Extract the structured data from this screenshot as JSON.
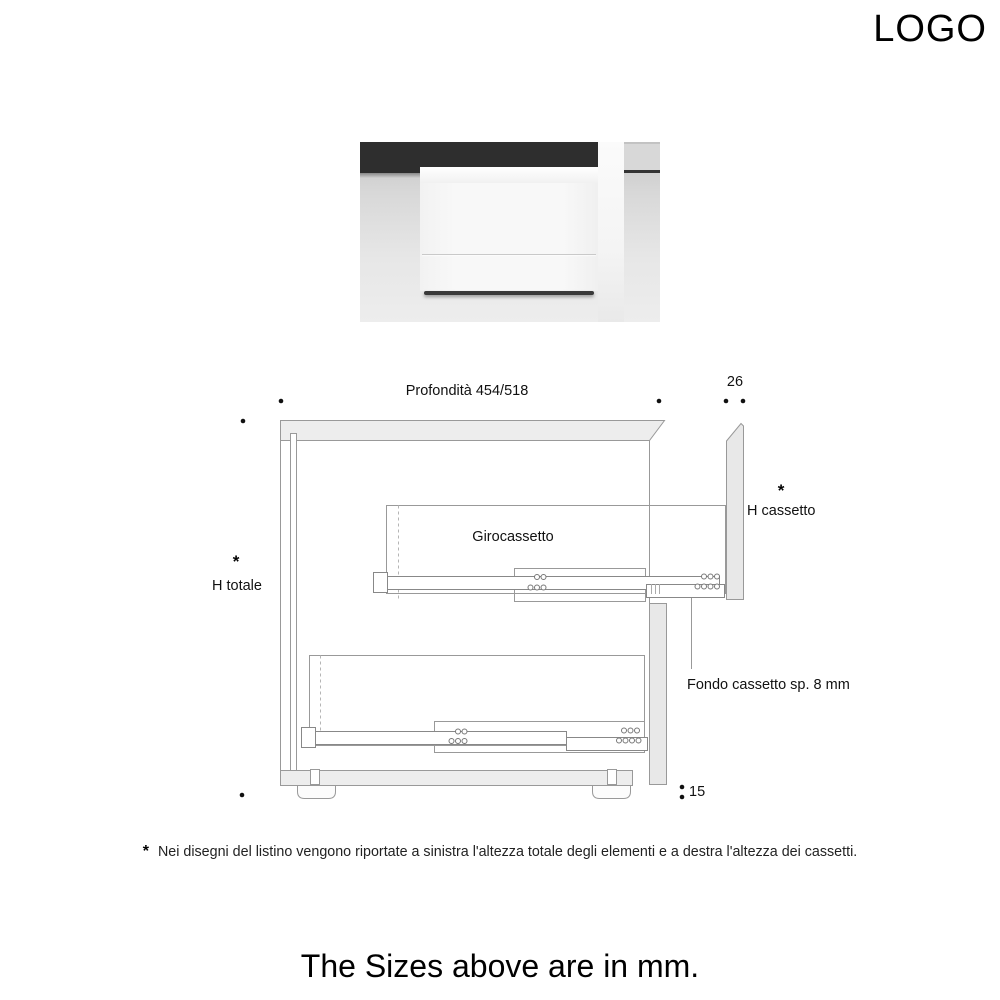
{
  "header": {
    "logo_text": "LOGO"
  },
  "drawing": {
    "dim_depth": "Profondità 454/518",
    "dim_front_thickness": "26",
    "label_drawer_height": "H cassetto",
    "label_total_height": "H totale",
    "label_drawer_box": "Girocassetto",
    "label_drawer_bottom": "Fondo cassetto sp. 8 mm",
    "dim_foot_height": "15",
    "asterisk": "*"
  },
  "footnote": {
    "marker": "*",
    "text": "Nei disegni del listino vengono riportate a sinistra l'altezza totale degli elementi e a destra l'altezza dei cassetti."
  },
  "units_note": "The Sizes above are in mm.",
  "colors": {
    "line": "#999999",
    "panel_fill": "#ededed",
    "front_panel_fill": "#e8e8e8",
    "text": "#1a1a1a",
    "wall_dark": "#2e2e2e",
    "background": "#ffffff"
  }
}
